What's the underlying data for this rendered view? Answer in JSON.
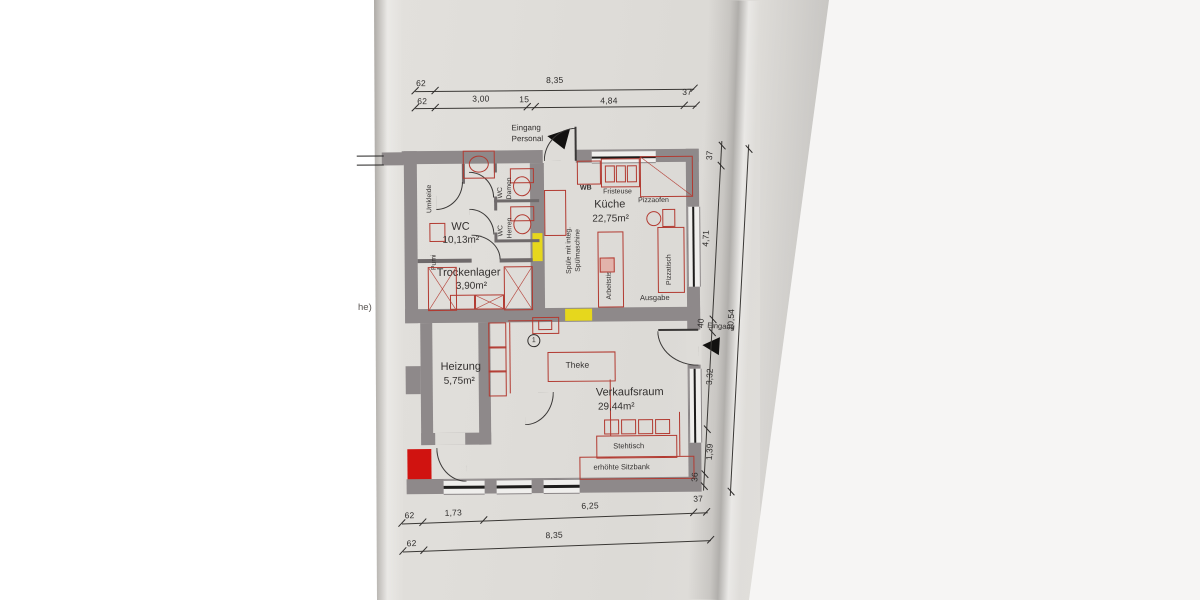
{
  "colors": {
    "wall": "#8e898a",
    "furniture_red": "#b23a31",
    "marked_red": "#d01310",
    "marked_yellow": "#e6d71d",
    "line": "#2e2c2b",
    "paper": "#dcdad6"
  },
  "rooms": {
    "wc": {
      "name": "WC",
      "area": "10,13m²"
    },
    "trockenlager": {
      "name": "Trockenlager",
      "area": "3,90m²"
    },
    "kueche": {
      "name": "Küche",
      "area": "22,75m²"
    },
    "heizung": {
      "name": "Heizung",
      "area": "5,75m²"
    },
    "verkaufsraum": {
      "name": "Verkaufsraum",
      "area": "29,44m²"
    }
  },
  "labels": {
    "eingang_personal_line1": "Eingang",
    "eingang_personal_line2": "Personal",
    "eingang": "Eingang",
    "umkleide": "Umkleide",
    "wc_short": "WC",
    "damen": "Damen",
    "herren": "Herren",
    "pumi": "Pumi",
    "spuele_line1": "Spüle mit integ.",
    "spuele_line2": "Spülmaschine",
    "wb": "WB",
    "fristeuse": "Fristeuse",
    "pizzaofen": "Pizzaofen",
    "pizzatisch": "Pizzatisch",
    "arbeitstisch": "Arbeitstisch",
    "ausgabe": "Ausgabe",
    "theke": "Theke",
    "stehtisch": "Stehtisch",
    "erhoehte_sitzbank": "erhöhte Sitzbank",
    "position_marker": "1",
    "cutoff_text": "he)"
  },
  "dimensions": {
    "top_row1": [
      "62",
      "8,35"
    ],
    "top_row2": [
      "62",
      "3,00",
      "15",
      "4,84",
      "37"
    ],
    "right_column": [
      "37",
      "4,71",
      "40",
      "10,54",
      "3,32",
      "1,39",
      "36"
    ],
    "bottom_row1": [
      "62",
      "1,73",
      "6,25",
      "37"
    ],
    "bottom_row2": [
      "62",
      "8,35"
    ]
  }
}
